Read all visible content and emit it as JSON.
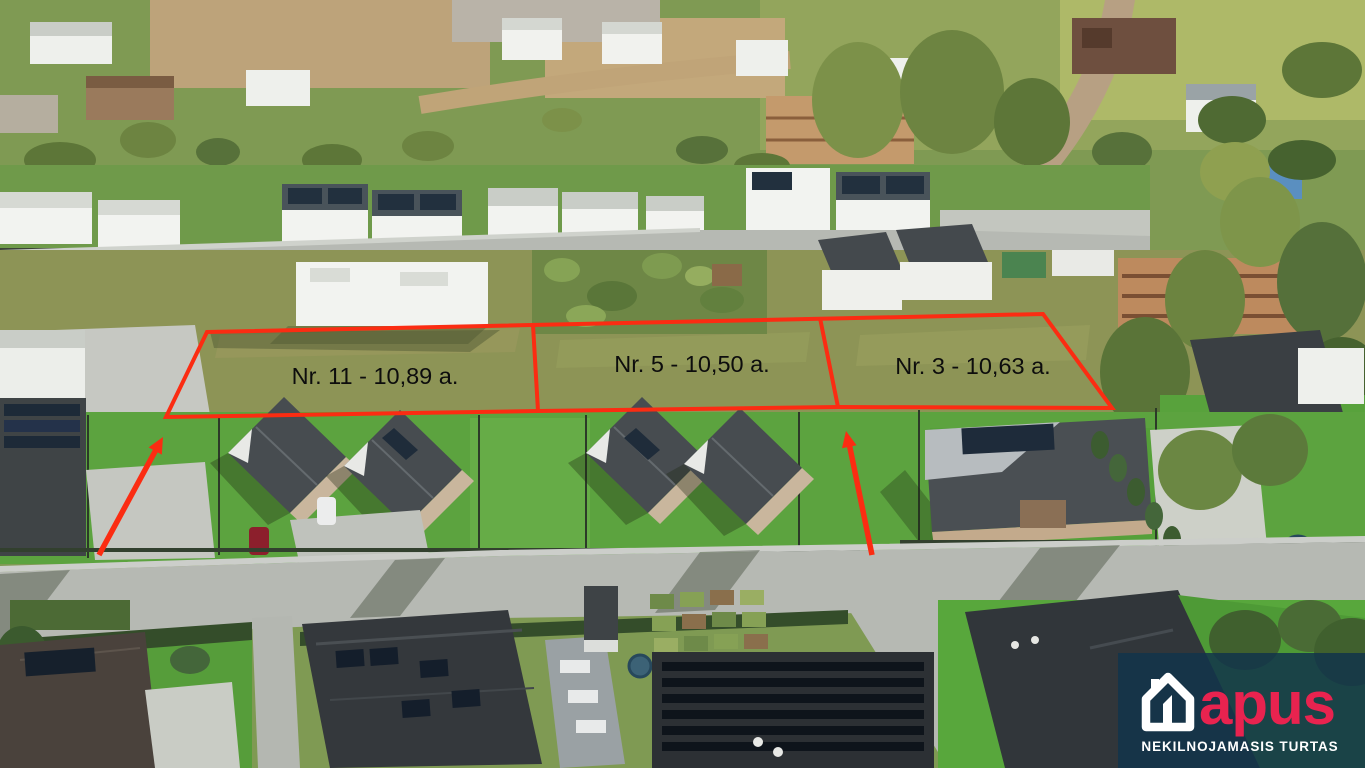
{
  "annotations": {
    "outline_color": "#fb2c12",
    "label_color": "#0d0d0d",
    "plots": [
      {
        "label": "Nr. 11 - 10,89 a."
      },
      {
        "label": "Nr. 5 - 10,50 a."
      },
      {
        "label": "Nr. 3 - 10,63 a."
      }
    ]
  },
  "logo": {
    "brand": "apus",
    "tagline": "NEKILNOJAMASIS TURTAS",
    "brand_color": "#e8234f",
    "text_color": "#ffffff",
    "overlay_color": "#12344a"
  }
}
